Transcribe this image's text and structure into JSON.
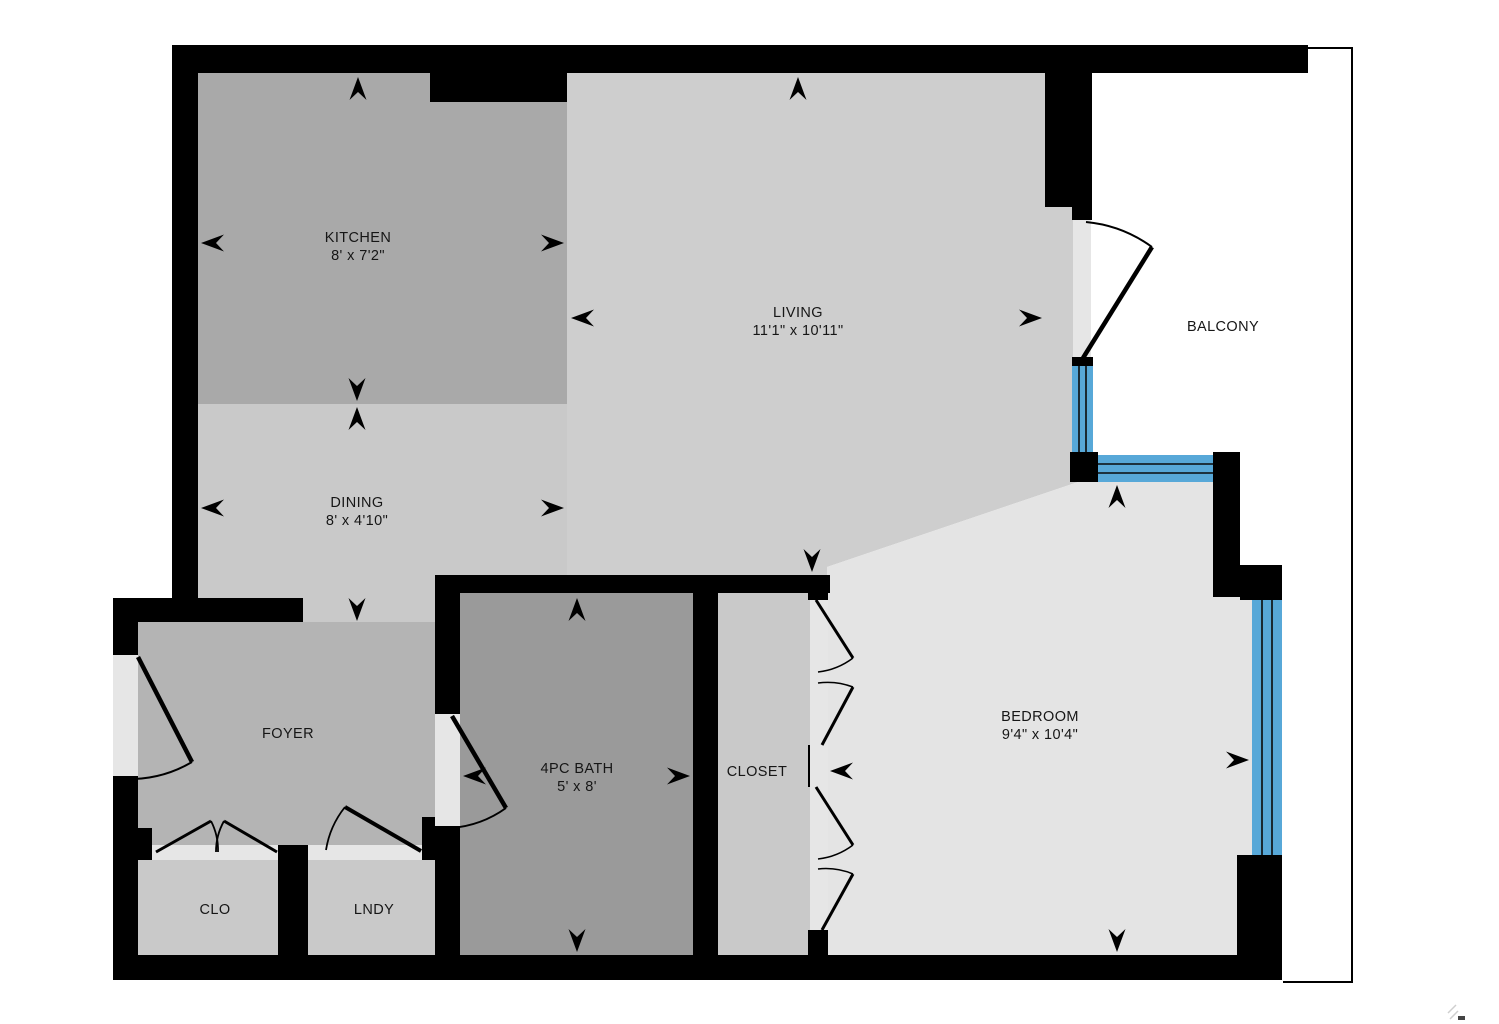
{
  "plan_title": "apartment-floor-plan",
  "rooms": {
    "kitchen": {
      "name": "KITCHEN",
      "dims": "8' x 7'2\""
    },
    "dining": {
      "name": "DINING",
      "dims": "8' x 4'10\""
    },
    "living": {
      "name": "LIVING",
      "dims": "11'1\" x 10'11\""
    },
    "balcony": {
      "name": "BALCONY"
    },
    "foyer": {
      "name": "FOYER"
    },
    "bath": {
      "name": "4PC BATH",
      "dims": "5' x 8'"
    },
    "closet": {
      "name": "CLOSET"
    },
    "bedroom": {
      "name": "BEDROOM",
      "dims": "9'4\" x 10'4\""
    },
    "clo": {
      "name": "CLO"
    },
    "lndy": {
      "name": "LNDY"
    }
  },
  "colors": {
    "wall": "#000000",
    "arrow": "#000000",
    "text": "#161616",
    "window_blue": "#57a8d8",
    "door_opening": "#e6e6e6",
    "balcony_floor": "#ffffff",
    "floor_kitchen": "#a9a9a9",
    "floor_dining": "#c9c9c9",
    "floor_living": "#cecece",
    "floor_foyer": "#b4b4b4",
    "floor_bath": "#9a9a9a",
    "floor_closet": "#c9c9c9",
    "floor_bedroom": "#e4e4e4",
    "floor_clo": "#c9c9c9",
    "floor_lndy": "#c9c9c9"
  }
}
